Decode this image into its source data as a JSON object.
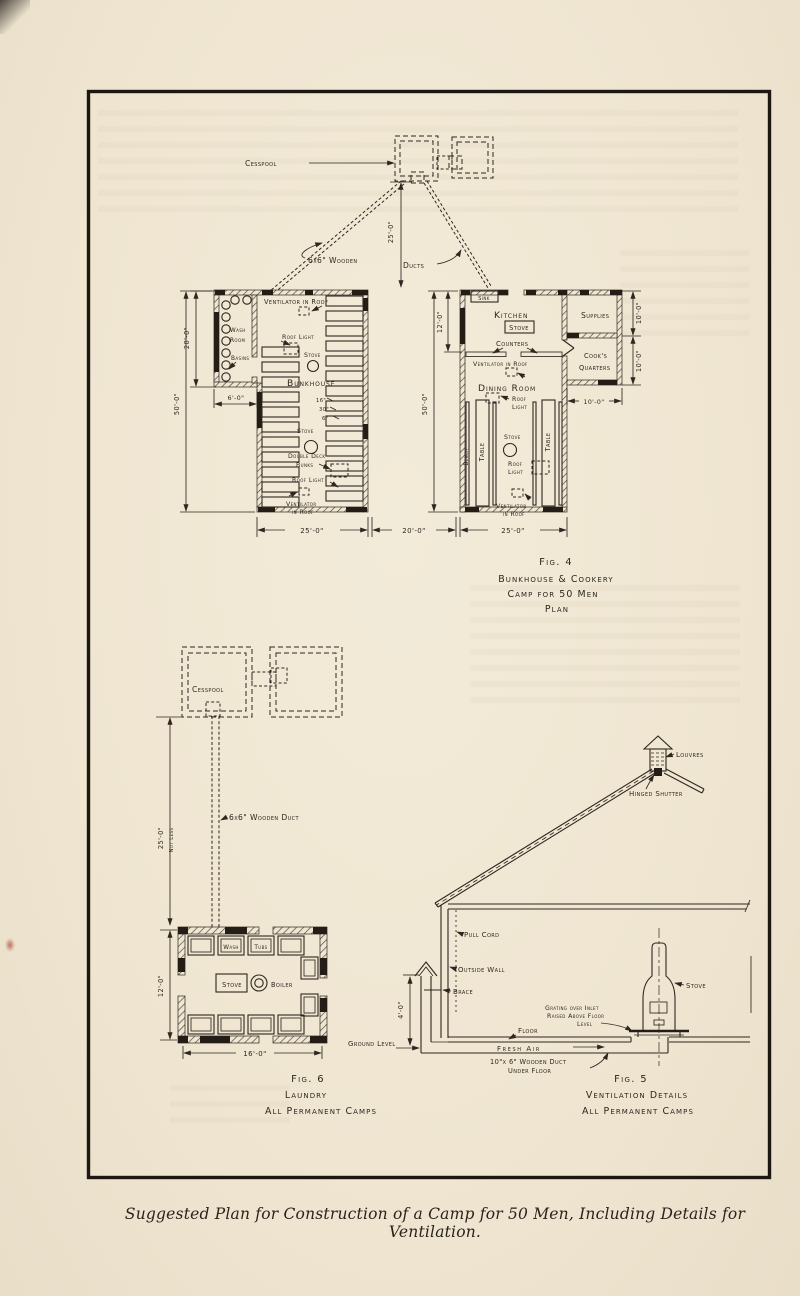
{
  "page": {
    "caption": "Suggested Plan for Construction of a Camp for 50 Men, Including Details for Ventilation."
  },
  "fig4": {
    "cesspool": "Cesspool",
    "dim_cesspool_dist": "25'-0\"",
    "duct_material": "6x6\" Wooden",
    "ducts": "Ducts",
    "bunkhouse": {
      "ventilator_top": "Ventilator in Roof",
      "wash": "Wash",
      "room": "Room",
      "basins": "Basins",
      "dim_annex_h": "20'-0\"",
      "dim_annex_w": "6'-0\"",
      "dim_height": "50'-0\"",
      "roof_light_a": "Roof Light",
      "stove_a": "Stove",
      "name": "Bunkhouse",
      "bunk_dim_1": "16\"",
      "bunk_dim_2": "30\"",
      "bunk_dim_3": "6\"",
      "stove_b": "Stove",
      "double_deck": "Double Deck",
      "bunks": "Bunks",
      "roof_light_b": "Roof Light",
      "ventilator": "Ventilator",
      "in_roof": "in Roof"
    },
    "cookery": {
      "sink": "Sink",
      "kitchen": "Kitchen",
      "stove_kitchen": "Stove",
      "counters": "Counters",
      "ventilator_kitchen": "Ventilator in Roof",
      "dining_room": "Dining Room",
      "roof_a": "Roof",
      "light_a": "Light",
      "stove_dining": "Stove",
      "roof_b": "Roof",
      "light_b": "Light",
      "ventilator": "Ventilator",
      "in_roof": "in Roof",
      "bench": "Bench",
      "table_a": "Table",
      "table_b": "Table",
      "supplies": "Supplies",
      "cooks": "Cook's",
      "quarters": "Quarters",
      "dim_kitchen_d": "12'-0\"",
      "dim_height": "50'-0\"",
      "dim_supplies": "10'-0\"",
      "dim_cooks": "10'-0\"",
      "dim_annex_w": "10'-0\""
    },
    "dims_bottom": [
      "25'-0\"",
      "20'-0\"",
      "25'-0\""
    ],
    "caption": [
      "Fig. 4",
      "Bunkhouse & Cookery",
      "Camp for 50 Men",
      "Plan"
    ]
  },
  "fig6": {
    "cesspool": "Cesspool",
    "dim_distance": "25'-0\"",
    "dim_distance_note": "Not Less",
    "duct": "6x6\" Wooden Duct",
    "wash": "Wash",
    "tubs": "Tubs",
    "stove": "Stove",
    "boiler": "Boiler",
    "dim_depth": "12'-0\"",
    "dim_width": "16'-0\"",
    "caption": [
      "Fig. 6",
      "Laundry",
      "All Permanent Camps"
    ]
  },
  "fig5": {
    "louvres": "Louvres",
    "hinged_shutter": "Hinged Shutter",
    "pull_cord": "Pull Cord",
    "outside_wall": "Outside Wall",
    "brace": "Brace",
    "dim_intake": "4'-0\"",
    "ground_level": "Ground Level",
    "floor": "Floor",
    "fresh_air": "Fresh Air",
    "duct_line1": "10\"x 6\" Wooden Duct",
    "duct_line2": "Under Floor",
    "grating_line1": "Grating over Inlet",
    "grating_line2": "Raised Above Floor",
    "grating_line3": "Level",
    "stove": "Stove",
    "caption": [
      "Fig. 5",
      "Ventilation Details",
      "All Permanent Camps"
    ]
  }
}
